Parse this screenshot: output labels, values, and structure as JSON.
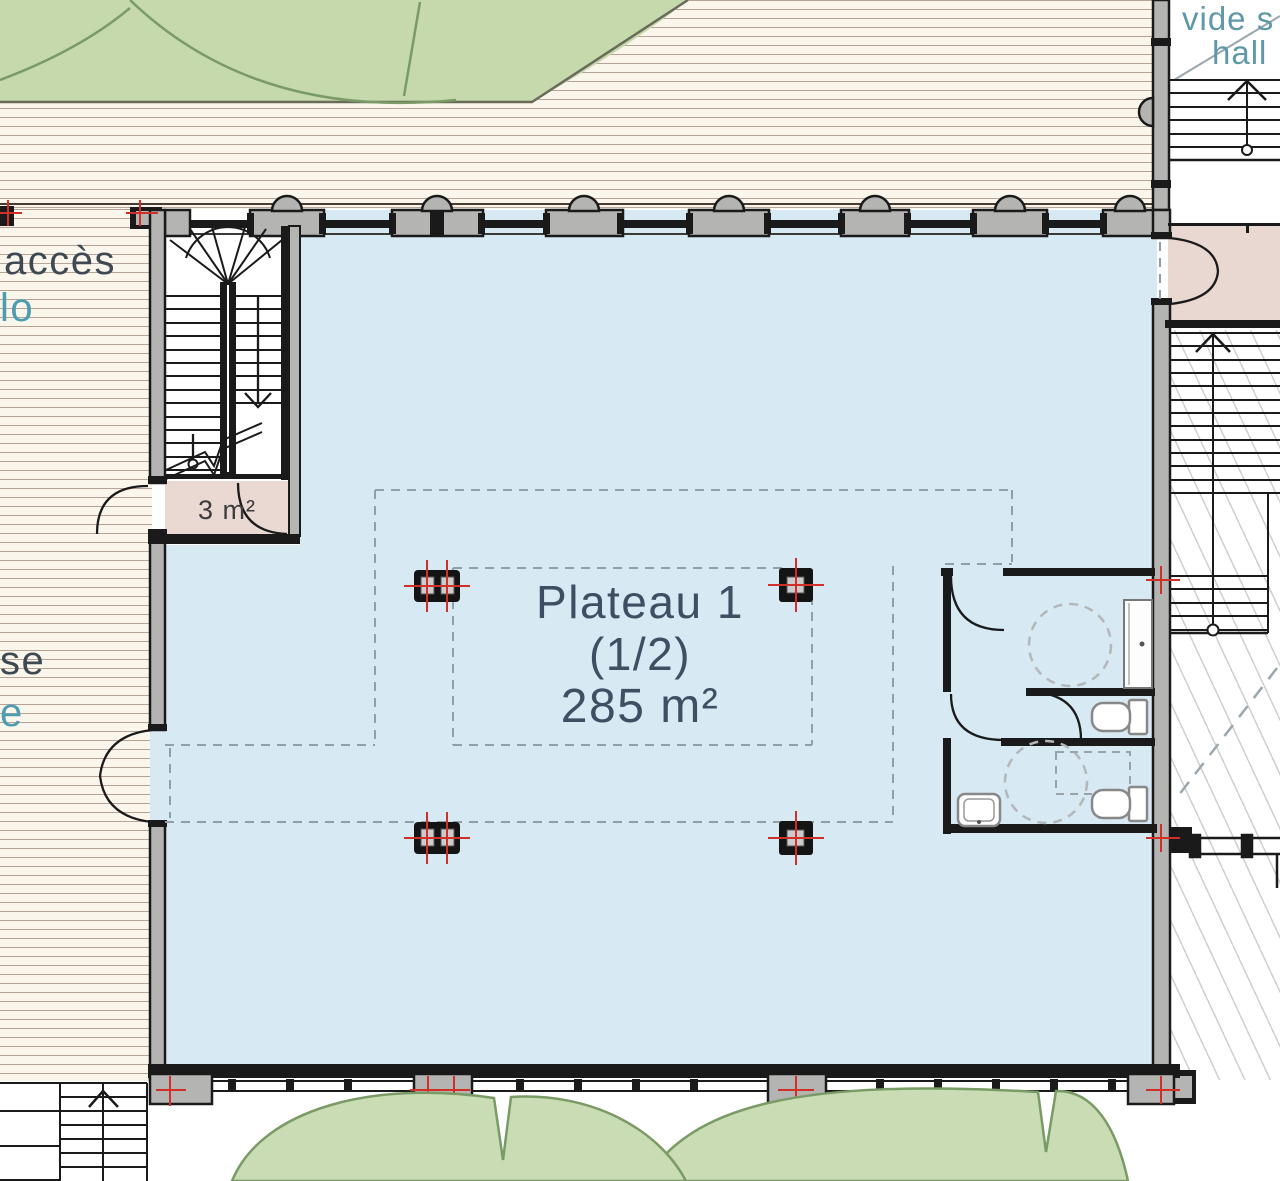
{
  "plan": {
    "main_room": {
      "name": "Plateau 1",
      "fraction": "(1/2)",
      "area": "285 m²"
    },
    "storage_room": {
      "area": "3 m²"
    },
    "left_edge_labels": {
      "line1": "accès",
      "line2": "lo",
      "line3": "se",
      "line4": "e"
    },
    "hall_labels": {
      "line1": "vide s",
      "line2": "hall"
    },
    "colors": {
      "floor_blue": "#d7e9f3",
      "room_pink": "#e9d8d1",
      "vegetation_green": "#c5d9ad",
      "tree_green": "#c9dcb4",
      "tree_outline": "#7a9a66",
      "wall_black": "#1a1a1a",
      "wall_gray": "#b4b4b2",
      "deck_cream": "#fbf6ec",
      "axis_marker_red": "#d03028",
      "dashed_line_gray": "#8fa0a8",
      "label_dark_blue": "#3d4f63",
      "label_teal": "#4d9cb0"
    }
  }
}
